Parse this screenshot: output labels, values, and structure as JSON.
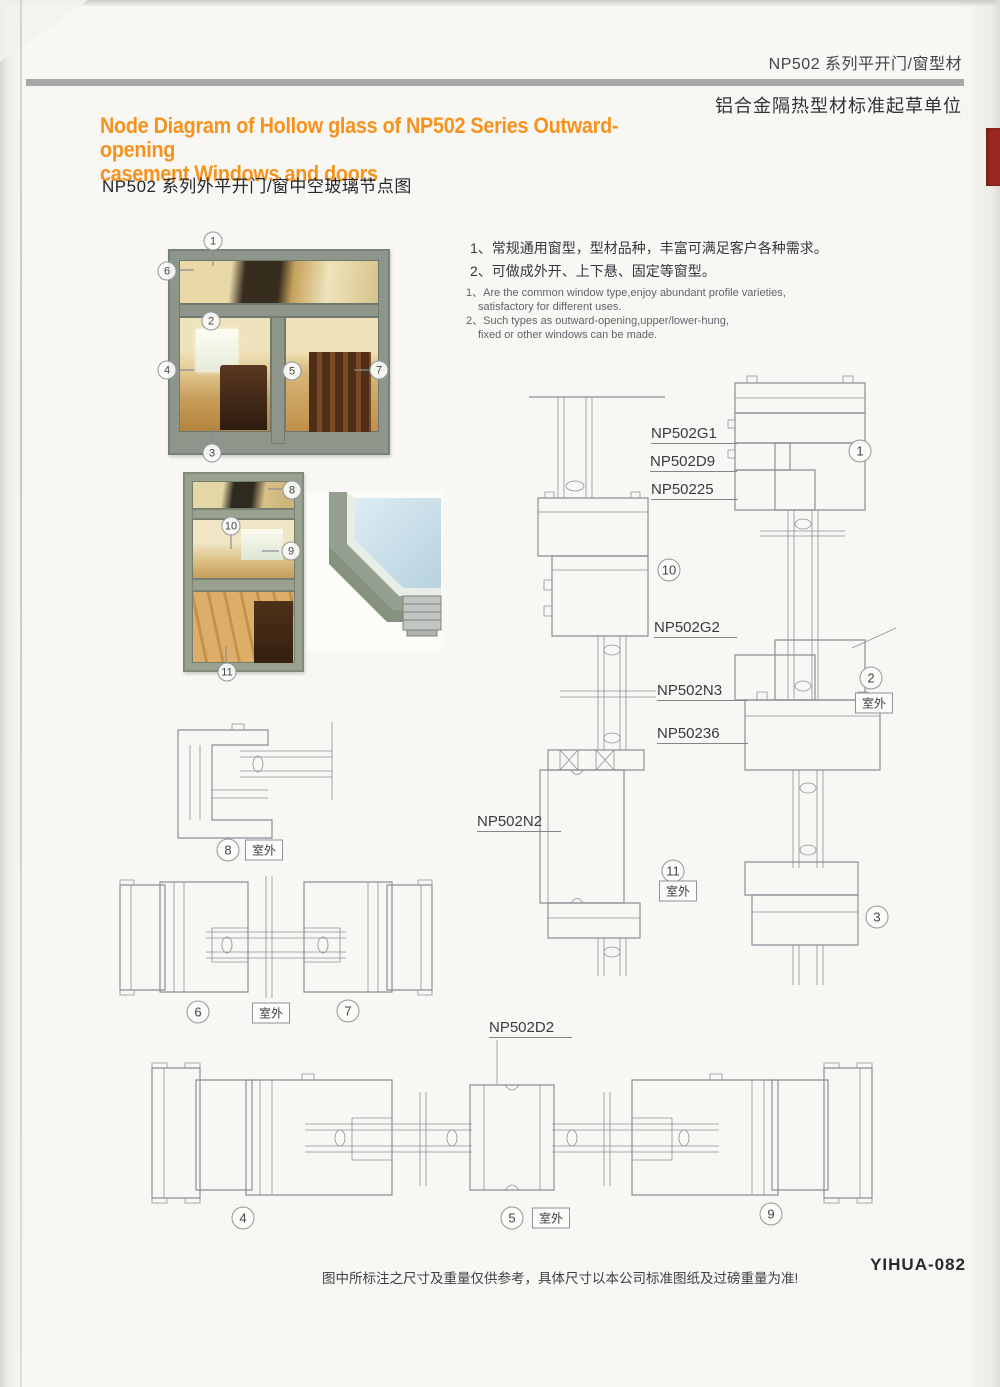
{
  "header": {
    "series_title": "NP502 系列平开门/窗型材",
    "org_subtitle": "铝合金隔热型材标准起草单位"
  },
  "title": {
    "en_line1": "Node Diagram of Hollow glass of NP502 Series Outward-opening",
    "en_line2": "casement Windows and doors",
    "zh": "NP502 系列外平开门/窗中空玻璃节点图"
  },
  "notes": {
    "zh1": "1、常规通用窗型，型材品种，丰富可满足客户各种需求。",
    "zh2": "2、可做成外开、上下悬、固定等窗型。",
    "en1": "1、Are the common window type,enjoy abundant profile varieties,",
    "en2": "satisfactory for different uses.",
    "en3": "2、Such types as outward-opening,upper/lower-hung,",
    "en4": "fixed or other windows can be made."
  },
  "profiles": {
    "g1": "NP502G1",
    "d9": "NP502D9",
    "p25": "NP50225",
    "g2": "NP502G2",
    "n3": "NP502N3",
    "p36": "NP50236",
    "n2": "NP502N2",
    "d2": "NP502D2"
  },
  "outdoor_label": "室外",
  "callouts": {
    "c1": "1",
    "c2": "2",
    "c3": "3",
    "c4": "4",
    "c5": "5",
    "c6": "6",
    "c7": "7",
    "c8": "8",
    "c9": "9",
    "c10": "10",
    "c11": "11"
  },
  "footer": {
    "disclaimer": "图中所标注之尺寸及重量仅供参考，具体尺寸以本公司标准图纸及过磅重量为准!",
    "page_code": "YIHUA-082"
  },
  "colors": {
    "accent_orange": "#f6921e",
    "header_bar_gray": "#a6a8aa",
    "cad_line_gray": "#878e95",
    "tab_red": "#9c2620",
    "photo_frame_green": "#8e968b"
  }
}
